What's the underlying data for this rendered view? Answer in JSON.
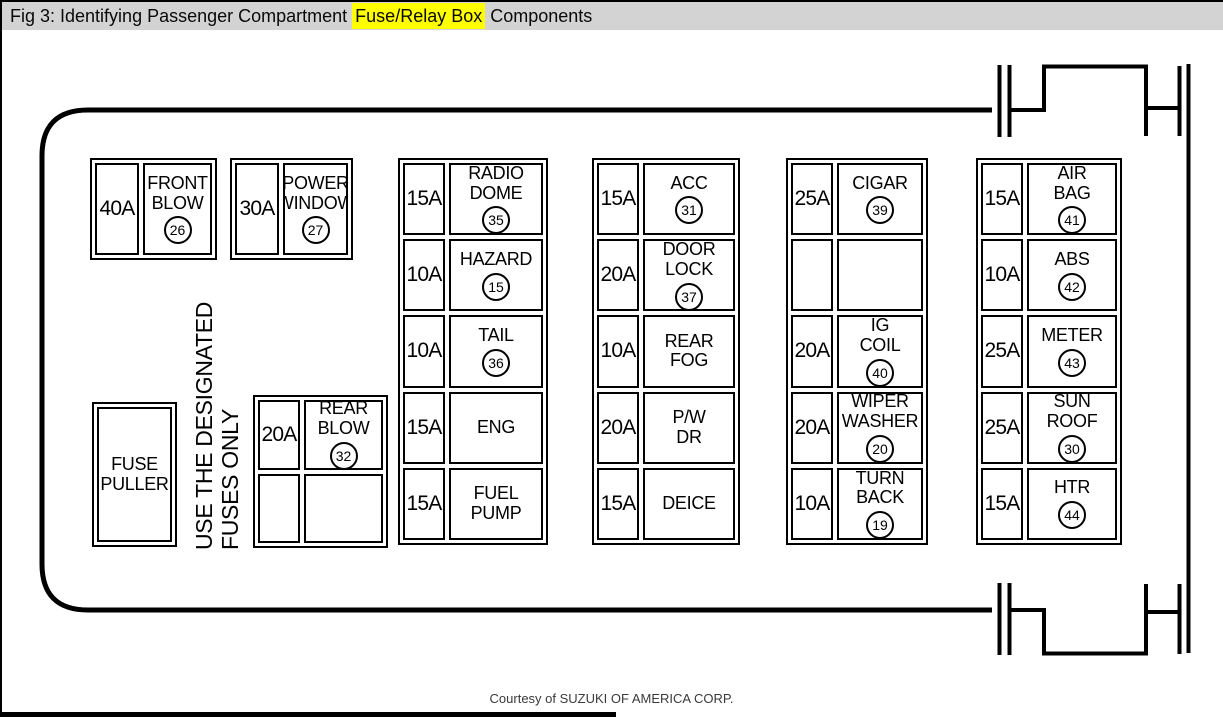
{
  "caption": {
    "prefix": "Fig 3: Identifying Passenger Compartment ",
    "highlight": "Fuse/Relay Box",
    "suffix": " Components"
  },
  "colors": {
    "caption_bar_bg": "#d3d3d3",
    "highlight_bg": "#ffff00",
    "diagram_line": "#000000"
  },
  "notes": {
    "fuse_puller": "FUSE\nPULLER",
    "designated": "USE THE DESIGNATED\nFUSES ONLY"
  },
  "credit": "Courtesy of SUZUKI OF AMERICA CORP.",
  "groups": {
    "front_blow": {
      "amp": "40A",
      "name": "FRONT\nBLOW",
      "num": "26"
    },
    "power_window": {
      "amp": "30A",
      "name": "POWER\nWINDOW",
      "num": "27"
    },
    "rear_blow": {
      "rows": [
        {
          "amp": "20A",
          "name": "REAR\nBLOW",
          "num": "32"
        },
        {
          "amp": "",
          "name": "",
          "num": ""
        }
      ]
    },
    "column1": {
      "rows": [
        {
          "amp": "15A",
          "name": "RADIO\nDOME",
          "num": "35"
        },
        {
          "amp": "10A",
          "name": "HAZARD",
          "num": "15"
        },
        {
          "amp": "10A",
          "name": "TAIL",
          "num": "36"
        },
        {
          "amp": "15A",
          "name": "ENG",
          "num": ""
        },
        {
          "amp": "15A",
          "name": "FUEL\nPUMP",
          "num": ""
        }
      ]
    },
    "column2": {
      "rows": [
        {
          "amp": "15A",
          "name": "ACC",
          "num": "31"
        },
        {
          "amp": "20A",
          "name": "DOOR\nLOCK",
          "num": "37"
        },
        {
          "amp": "10A",
          "name": "REAR\nFOG",
          "num": ""
        },
        {
          "amp": "20A",
          "name": "P/W\nDR",
          "num": ""
        },
        {
          "amp": "15A",
          "name": "DEICE",
          "num": ""
        }
      ]
    },
    "column3": {
      "rows": [
        {
          "amp": "25A",
          "name": "CIGAR",
          "num": "39"
        },
        {
          "amp": "",
          "name": "",
          "num": ""
        },
        {
          "amp": "20A",
          "name": "IG\nCOIL",
          "num": "40"
        },
        {
          "amp": "20A",
          "name": "WIPER\nWASHER",
          "num": "20"
        },
        {
          "amp": "10A",
          "name": "TURN\nBACK",
          "num": "19"
        }
      ]
    },
    "column4": {
      "rows": [
        {
          "amp": "15A",
          "name": "AIR\nBAG",
          "num": "41"
        },
        {
          "amp": "10A",
          "name": "ABS",
          "num": "42"
        },
        {
          "amp": "25A",
          "name": "METER",
          "num": "43"
        },
        {
          "amp": "25A",
          "name": "SUN\nROOF",
          "num": "30"
        },
        {
          "amp": "15A",
          "name": "HTR",
          "num": "44"
        }
      ]
    }
  }
}
